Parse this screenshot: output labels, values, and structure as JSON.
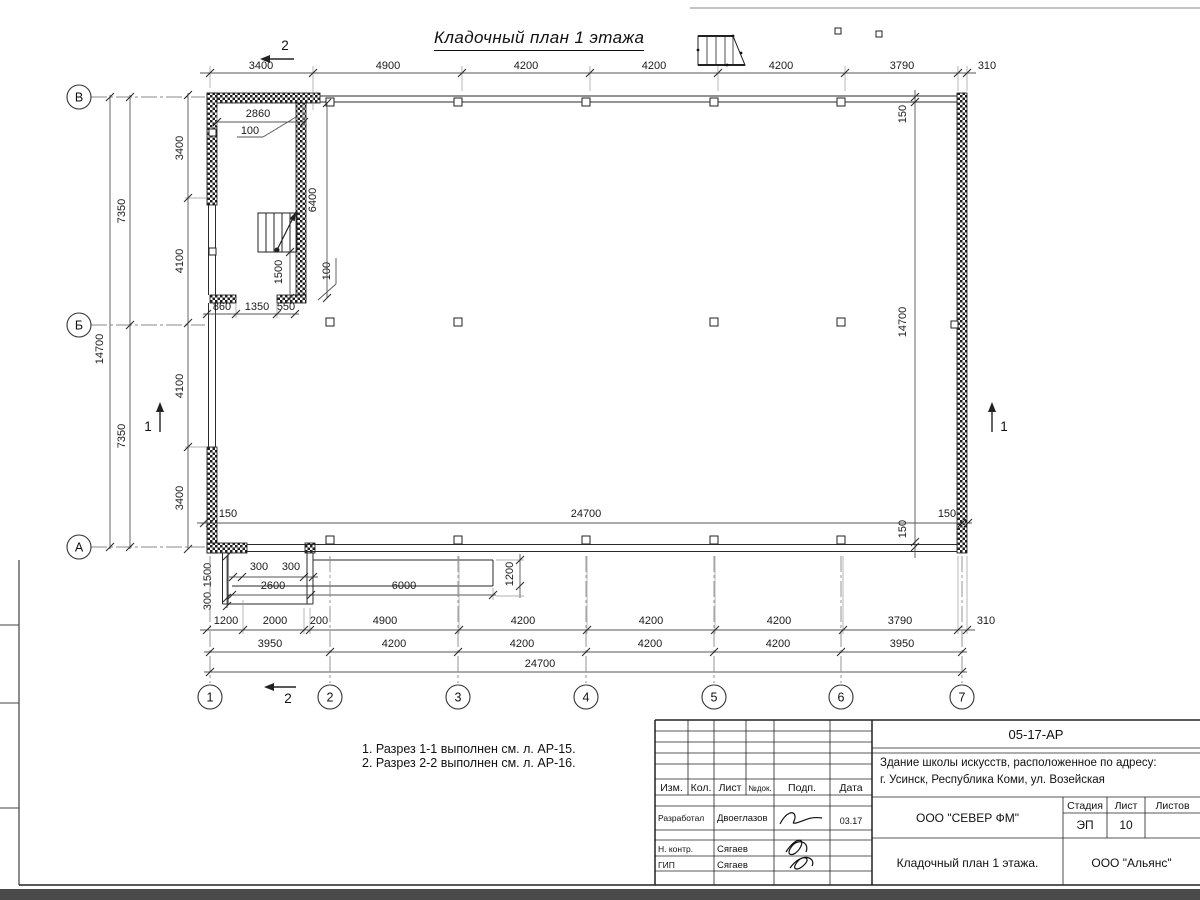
{
  "sheet": {
    "title": "Кладочный план 1 этажа"
  },
  "notes": {
    "line1": "1. Разрез 1-1 выполнен см. л. АР-15.",
    "line2": "2. Разрез 2-2 выполнен см. л. АР-16."
  },
  "plan": {
    "axes": {
      "rows": [
        {
          "label": "В",
          "y": 97
        },
        {
          "label": "Б",
          "y": 325
        },
        {
          "label": "А",
          "y": 547
        }
      ],
      "cols": [
        {
          "label": "1",
          "x": 210
        },
        {
          "label": "2",
          "x": 330
        },
        {
          "label": "3",
          "x": 458
        },
        {
          "label": "4",
          "x": 586
        },
        {
          "label": "5",
          "x": 714
        },
        {
          "label": "6",
          "x": 841
        },
        {
          "label": "7",
          "x": 962
        }
      ]
    },
    "labels": [
      {
        "t": "3400",
        "x": 261,
        "y": 69
      },
      {
        "t": "4900",
        "x": 388,
        "y": 69
      },
      {
        "t": "4200",
        "x": 526,
        "y": 69
      },
      {
        "t": "4200",
        "x": 654,
        "y": 69
      },
      {
        "t": "4200",
        "x": 781,
        "y": 69
      },
      {
        "t": "3790",
        "x": 902,
        "y": 69
      },
      {
        "t": "310",
        "x": 987,
        "y": 69
      },
      {
        "t": "2860",
        "x": 258,
        "y": 117
      },
      {
        "t": "100",
        "x": 250,
        "y": 134
      },
      {
        "t": "6400",
        "x": 316,
        "y": 200,
        "r": -90
      },
      {
        "t": "1500",
        "x": 282,
        "y": 272,
        "r": -90
      },
      {
        "t": "100",
        "x": 330,
        "y": 271,
        "r": -90
      },
      {
        "t": "860",
        "x": 222,
        "y": 310
      },
      {
        "t": "1350",
        "x": 257,
        "y": 310
      },
      {
        "t": "550",
        "x": 286,
        "y": 310
      },
      {
        "t": "3400",
        "x": 183,
        "y": 148,
        "r": -90
      },
      {
        "t": "4100",
        "x": 183,
        "y": 261,
        "r": -90
      },
      {
        "t": "4100",
        "x": 183,
        "y": 386,
        "r": -90
      },
      {
        "t": "3400",
        "x": 183,
        "y": 498,
        "r": -90
      },
      {
        "t": "7350",
        "x": 125,
        "y": 211,
        "r": -90
      },
      {
        "t": "7350",
        "x": 125,
        "y": 436,
        "r": -90
      },
      {
        "t": "14700",
        "x": 103,
        "y": 349,
        "r": -90
      },
      {
        "t": "150",
        "x": 906,
        "y": 114,
        "r": -90
      },
      {
        "t": "14700",
        "x": 906,
        "y": 322,
        "r": -90
      },
      {
        "t": "150",
        "x": 906,
        "y": 529,
        "r": -90
      },
      {
        "t": "150",
        "x": 228,
        "y": 517
      },
      {
        "t": "24700",
        "x": 586,
        "y": 517
      },
      {
        "t": "150",
        "x": 947,
        "y": 517
      },
      {
        "t": "300",
        "x": 259,
        "y": 570
      },
      {
        "t": "300",
        "x": 291,
        "y": 570
      },
      {
        "t": "2600",
        "x": 273,
        "y": 589
      },
      {
        "t": "6000",
        "x": 404,
        "y": 589
      },
      {
        "t": "1200",
        "x": 513,
        "y": 574,
        "r": -90
      },
      {
        "t": "1500",
        "x": 211,
        "y": 575,
        "r": -90
      },
      {
        "t": "300",
        "x": 211,
        "y": 601,
        "r": -90
      },
      {
        "t": "1200",
        "x": 226,
        "y": 624
      },
      {
        "t": "2000",
        "x": 275,
        "y": 624
      },
      {
        "t": "200",
        "x": 319,
        "y": 624
      },
      {
        "t": "4900",
        "x": 385,
        "y": 624
      },
      {
        "t": "4200",
        "x": 523,
        "y": 624
      },
      {
        "t": "4200",
        "x": 651,
        "y": 624
      },
      {
        "t": "4200",
        "x": 779,
        "y": 624
      },
      {
        "t": "3790",
        "x": 900,
        "y": 624
      },
      {
        "t": "310",
        "x": 986,
        "y": 624
      },
      {
        "t": "3950",
        "x": 270,
        "y": 647
      },
      {
        "t": "4200",
        "x": 394,
        "y": 647
      },
      {
        "t": "4200",
        "x": 522,
        "y": 647
      },
      {
        "t": "4200",
        "x": 650,
        "y": 647
      },
      {
        "t": "4200",
        "x": 778,
        "y": 647
      },
      {
        "t": "3950",
        "x": 902,
        "y": 647
      },
      {
        "t": "24700",
        "x": 540,
        "y": 667
      },
      {
        "t": "2",
        "x": 285,
        "y": 50,
        "s": "sec"
      },
      {
        "t": "2",
        "x": 288,
        "y": 703,
        "s": "sec"
      },
      {
        "t": "1",
        "x": 148,
        "y": 431,
        "s": "sec"
      },
      {
        "t": "1",
        "x": 1004,
        "y": 431,
        "s": "sec"
      }
    ]
  },
  "title_block": {
    "doc_code": "05-17-АР",
    "object_line1": "Здание школы искусств, расположенное по адресу:",
    "object_line2": "г. Усинск, Республика Коми, ул. Возейская",
    "org1": "ООО \"СЕВЕР ФМ\"",
    "stage_label": "Стадия",
    "sheet_label": "Лист",
    "sheets_label": "Листов",
    "stage": "ЭП",
    "sheet_no": "10",
    "drawing_name": "Кладочный план 1 этажа.",
    "org2": "ООО \"Альянс\"",
    "cols": [
      "Изм.",
      "Кол.",
      "Лист",
      "№док.",
      "Подп.",
      "Дата"
    ],
    "rows": [
      {
        "role": "Разработал",
        "name": "Двоеглазов",
        "date": "03.17"
      },
      {
        "role": "Н. контр.",
        "name": "Сягаев"
      },
      {
        "role": "ГИП",
        "name": "Сягаев"
      }
    ]
  }
}
